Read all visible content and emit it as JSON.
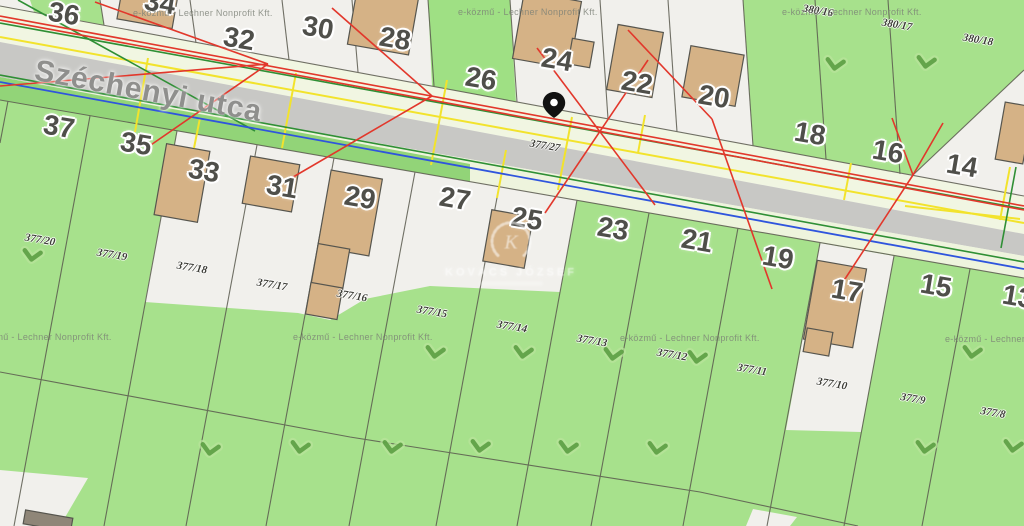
{
  "map": {
    "street_name": "Széchenyi utca",
    "watermark_provider": "e-közmű - Lechner Nonprofit Kft.",
    "watermark_center": {
      "monogram": "K",
      "name": "KOVÁCS JÓZSEF"
    },
    "pin": {
      "x": 554,
      "y": 118,
      "description": "location-pin"
    },
    "colors": {
      "parcel_green": "#a7e18c",
      "verge_pale": "#f1f6e2",
      "road_gray": "#c8c8c5",
      "parcel_white": "#f1f0ec",
      "utility_red": "#e2372b",
      "utility_green": "#2f8f35",
      "utility_yellow": "#f2e32c",
      "utility_blue": "#2f55dd",
      "building_tan": "#d5b286"
    },
    "house_numbers": [
      {
        "label": "36",
        "x": 64,
        "y": 14
      },
      {
        "label": "34",
        "x": 160,
        "y": 3
      },
      {
        "label": "32",
        "x": 239,
        "y": 39
      },
      {
        "label": "30",
        "x": 318,
        "y": 28
      },
      {
        "label": "28",
        "x": 395,
        "y": 39
      },
      {
        "label": "26",
        "x": 481,
        "y": 79
      },
      {
        "label": "24",
        "x": 557,
        "y": 60
      },
      {
        "label": "22",
        "x": 637,
        "y": 83
      },
      {
        "label": "20",
        "x": 714,
        "y": 97
      },
      {
        "label": "18",
        "x": 810,
        "y": 134
      },
      {
        "label": "16",
        "x": 888,
        "y": 152
      },
      {
        "label": "14",
        "x": 962,
        "y": 166
      },
      {
        "label": "37",
        "x": 59,
        "y": 127
      },
      {
        "label": "35",
        "x": 136,
        "y": 144
      },
      {
        "label": "33",
        "x": 204,
        "y": 171
      },
      {
        "label": "31",
        "x": 282,
        "y": 187
      },
      {
        "label": "29",
        "x": 360,
        "y": 198
      },
      {
        "label": "27",
        "x": 455,
        "y": 199
      },
      {
        "label": "25",
        "x": 527,
        "y": 219
      },
      {
        "label": "23",
        "x": 613,
        "y": 229
      },
      {
        "label": "21",
        "x": 697,
        "y": 241
      },
      {
        "label": "19",
        "x": 778,
        "y": 258
      },
      {
        "label": "17",
        "x": 847,
        "y": 291
      },
      {
        "label": "15",
        "x": 936,
        "y": 286
      },
      {
        "label": "13",
        "x": 1018,
        "y": 297
      }
    ],
    "lot_numbers": [
      {
        "label": "377/27",
        "x": 545,
        "y": 146
      },
      {
        "label": "380/16",
        "x": 818,
        "y": 11
      },
      {
        "label": "380/17",
        "x": 897,
        "y": 25
      },
      {
        "label": "380/18",
        "x": 978,
        "y": 40
      },
      {
        "label": "377/20",
        "x": 40,
        "y": 240
      },
      {
        "label": "377/19",
        "x": 112,
        "y": 255
      },
      {
        "label": "377/18",
        "x": 192,
        "y": 268
      },
      {
        "label": "377/17",
        "x": 272,
        "y": 285
      },
      {
        "label": "377/16",
        "x": 352,
        "y": 296
      },
      {
        "label": "377/15",
        "x": 432,
        "y": 312
      },
      {
        "label": "377/14",
        "x": 512,
        "y": 327
      },
      {
        "label": "377/13",
        "x": 592,
        "y": 341
      },
      {
        "label": "377/12",
        "x": 672,
        "y": 355
      },
      {
        "label": "377/11",
        "x": 752,
        "y": 370
      },
      {
        "label": "377/10",
        "x": 832,
        "y": 384
      },
      {
        "label": "377/9",
        "x": 913,
        "y": 399
      },
      {
        "label": "377/8",
        "x": 993,
        "y": 413
      }
    ],
    "provider_watermarks": [
      {
        "x": 133,
        "y": 8
      },
      {
        "x": 458,
        "y": 7
      },
      {
        "x": 782,
        "y": 7
      },
      {
        "x": -28,
        "y": 332
      },
      {
        "x": 293,
        "y": 332
      },
      {
        "x": 620,
        "y": 333
      },
      {
        "x": 945,
        "y": 334
      }
    ],
    "chevrons": [
      [
        835,
        65
      ],
      [
        926,
        63
      ],
      [
        32,
        256
      ],
      [
        435,
        353
      ],
      [
        523,
        353
      ],
      [
        613,
        355
      ],
      [
        697,
        358
      ],
      [
        972,
        353
      ],
      [
        210,
        450
      ],
      [
        300,
        448
      ],
      [
        392,
        448
      ],
      [
        480,
        447
      ],
      [
        568,
        448
      ],
      [
        657,
        449
      ],
      [
        925,
        448
      ],
      [
        1013,
        447
      ]
    ]
  }
}
